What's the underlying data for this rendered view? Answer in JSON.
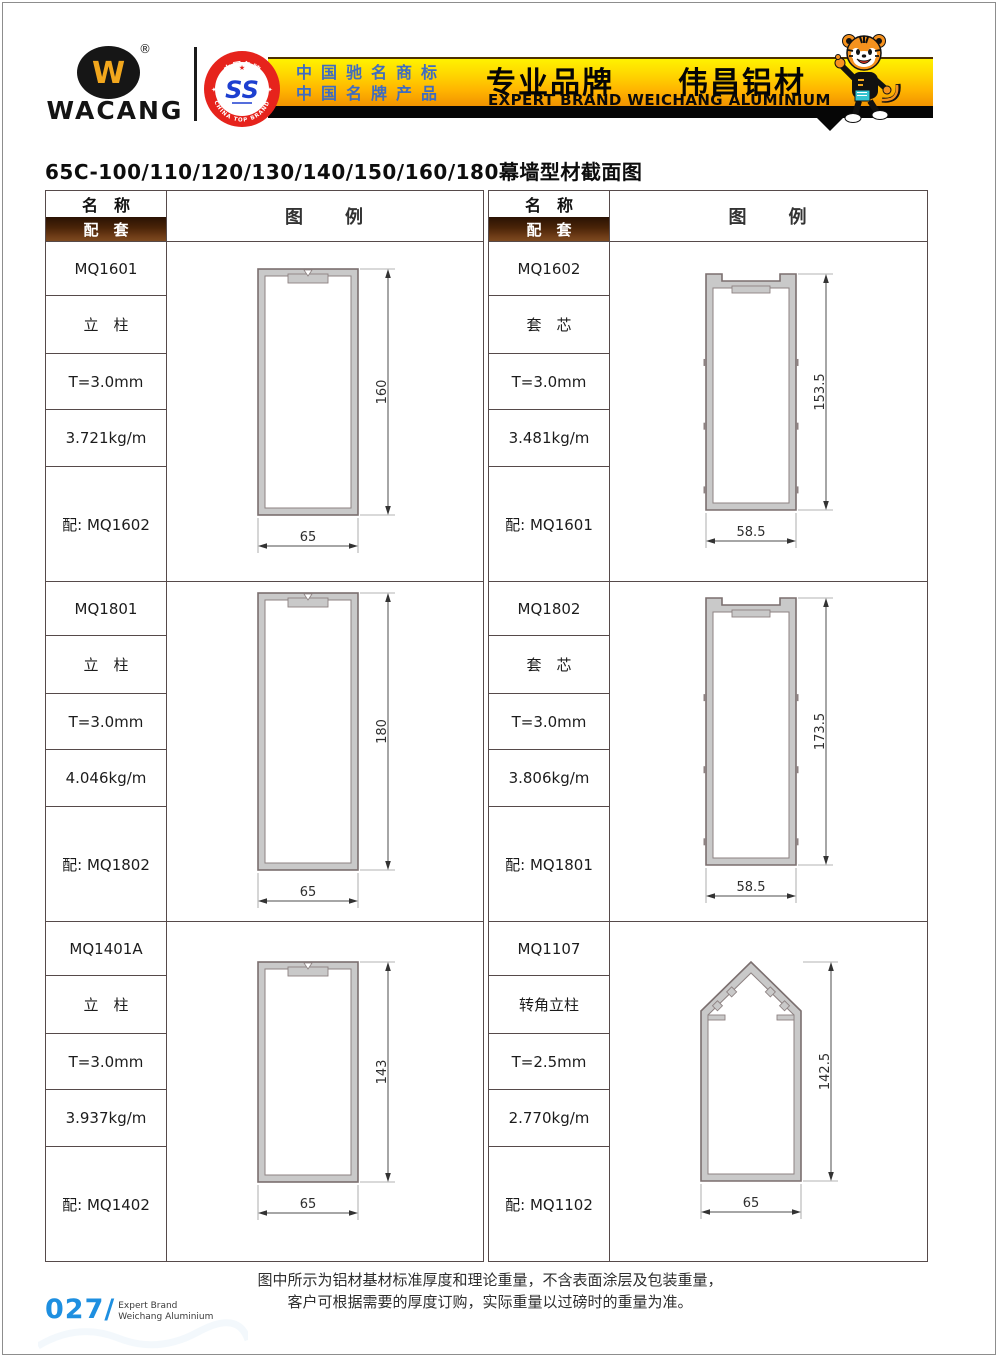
{
  "header": {
    "logo_glyph": "W",
    "logo_registered": "®",
    "logo_text": "WACANG",
    "badge": {
      "ring_top_text": "中国名牌",
      "ring_bottom_text": "CHINA TOP BRAND",
      "glyph": "SS"
    },
    "banner": {
      "line1": "中国驰名商标",
      "line2": "中国名牌产品",
      "title_cn": "专业品牌　　伟昌铝材",
      "title_en": "EXPERT BRAND WEICHANG ALUMINIUM"
    }
  },
  "page_title": "65C-100/110/120/130/140/150/160/180幕墙型材截面图",
  "table": {
    "col_name_header": "名　称",
    "col_match_header": "配　套",
    "col_diagram_header": "图　　例"
  },
  "profiles": [
    {
      "model": "MQ1601",
      "type_label": "立　柱",
      "thickness": "T=3.0mm",
      "weight": "3.721kg/m",
      "match": "配: MQ1602",
      "shape": "mullion",
      "height_label": "160",
      "width_label": "65"
    },
    {
      "model": "MQ1602",
      "type_label": "套　芯",
      "thickness": "T=3.0mm",
      "weight": "3.481kg/m",
      "match": "配: MQ1601",
      "shape": "sleeve",
      "height_label": "153.5",
      "width_label": "58.5"
    },
    {
      "model": "MQ1801",
      "type_label": "立　柱",
      "thickness": "T=3.0mm",
      "weight": "4.046kg/m",
      "match": "配: MQ1802",
      "shape": "mullion",
      "height_label": "180",
      "width_label": "65"
    },
    {
      "model": "MQ1802",
      "type_label": "套　芯",
      "thickness": "T=3.0mm",
      "weight": "3.806kg/m",
      "match": "配: MQ1801",
      "shape": "sleeve",
      "height_label": "173.5",
      "width_label": "58.5"
    },
    {
      "model": "MQ1401A",
      "type_label": "立　柱",
      "thickness": "T=3.0mm",
      "weight": "3.937kg/m",
      "match": "配: MQ1402",
      "shape": "mullion",
      "height_label": "143",
      "width_label": "65"
    },
    {
      "model": "MQ1107",
      "type_label": "转角立柱",
      "thickness": "T=2.5mm",
      "weight": "2.770kg/m",
      "match": "配: MQ1102",
      "shape": "corner",
      "height_label": "142.5",
      "width_label": "65"
    }
  ],
  "footer": {
    "note_line1": "图中所示为铝材基材标准厚度和理论重量，不含表面涂层及包装重量，",
    "note_line2": "客户可根据需要的厚度订购，实际重量以过磅时的重量为准。",
    "page_number": "027/",
    "page_brand_line1": "Expert Brand",
    "page_brand_line2": "Weichang Aluminium"
  },
  "colors": {
    "banner_gold_top": "#fff200",
    "banner_gold_bottom": "#ef8e00",
    "banner_text_blue": "#3f6cc0",
    "header_bar_brown": "#4a2408",
    "badge_red": "#e6231c",
    "logo_yellow": "#f2a71d",
    "page_number_blue": "#1e8fe0",
    "profile_gray": "#c9c9c9"
  }
}
